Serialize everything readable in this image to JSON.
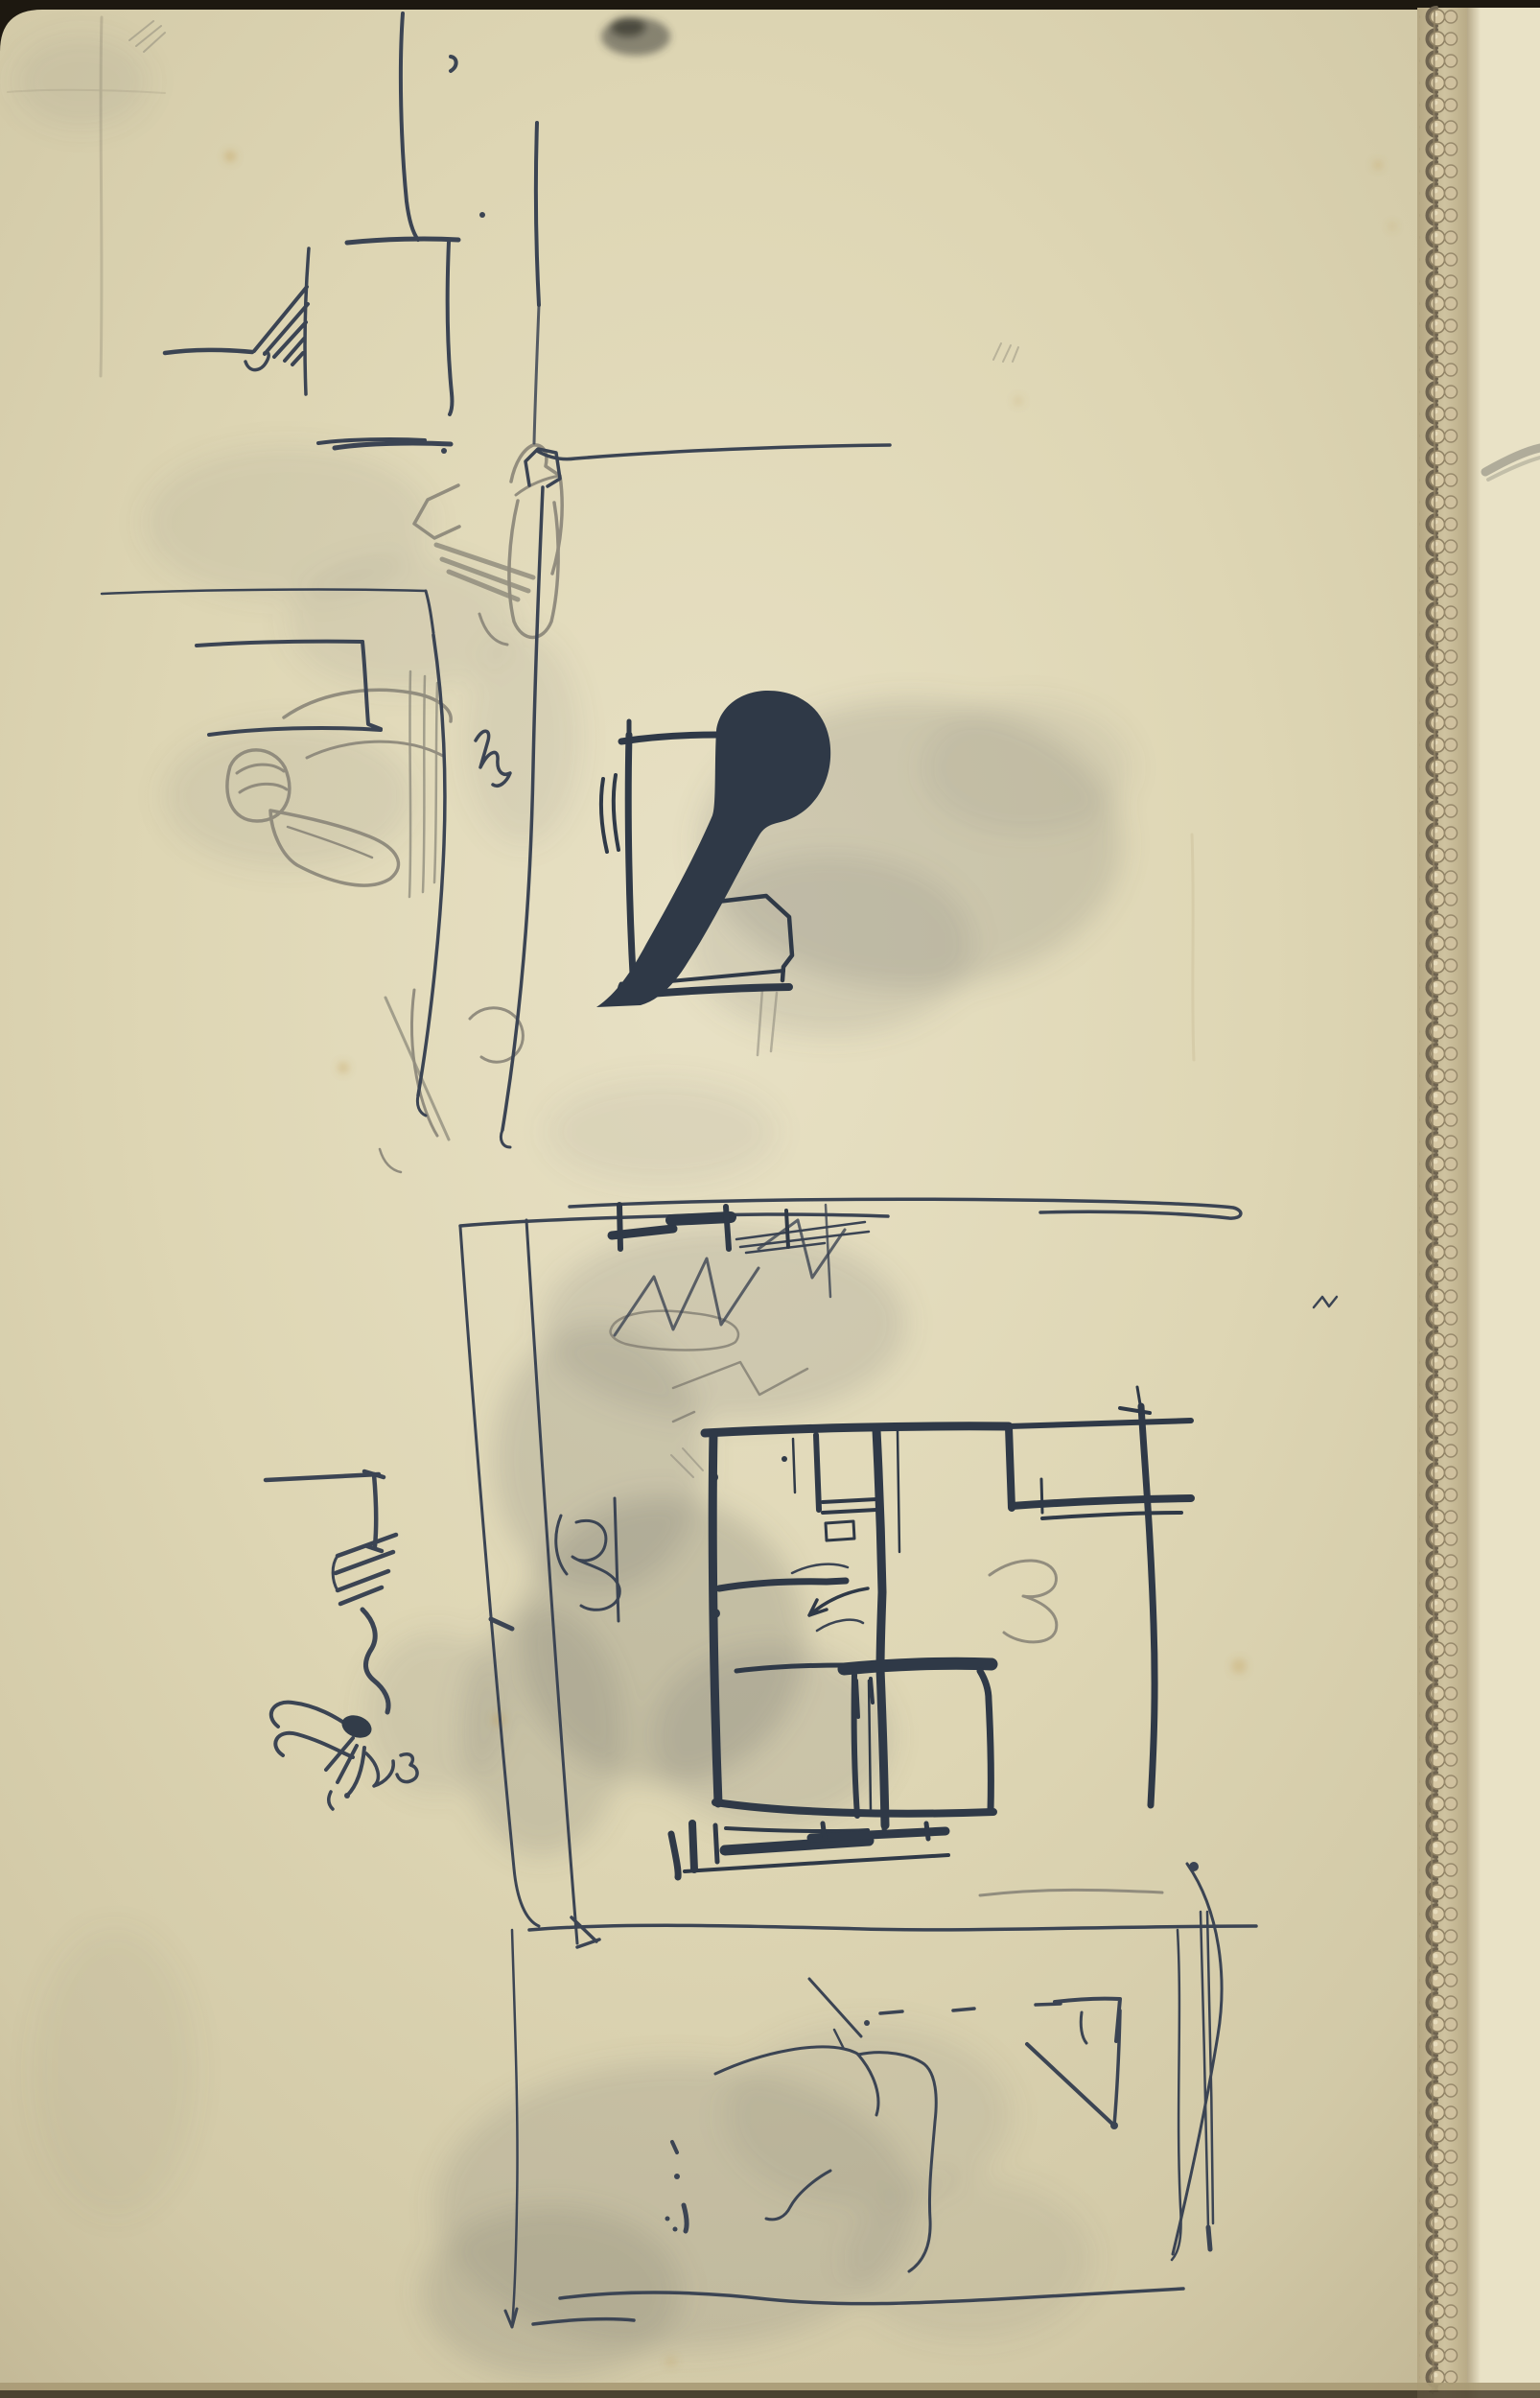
{
  "artwork": {
    "kind": "scanned sketchbook page",
    "media": "pen and ink with graphite on aged cream paper",
    "regions": {
      "top_left_sketch": "loose ink lines and zigzag scribble forming room corner",
      "table_scene": "pencil figures seated at a table drawn over thin ink lines",
      "ink_blot": "large dark ink blot with round head and diagonal tail inside a drawn frame",
      "floor_plan": "heavy ink floor-plan of rooms inside a larger light rectangle",
      "bird_scribble": "dense dark ink scribble resembling a bird below a flag-like bracket",
      "bottom_marks": "loose pencil branch lines, ink triangle and wavy base line",
      "binding": "vertical stitched perforation chain of the sketchbook on the right edge"
    }
  },
  "colors": {
    "scan_background": "#1d1810",
    "paper": "#ded6b4",
    "paper_light": "#e8e1c5",
    "paper_edge": "#c2b795",
    "ink": "#3b4453",
    "ink_heavy": "#2f3947",
    "pencil": "#8b8779",
    "smudge": "#70706a",
    "stain": "#c09a50",
    "binding_bead": "#d7c8a4",
    "binding_shadow": "#6f6450",
    "bottom_edge": "#a89a74"
  }
}
